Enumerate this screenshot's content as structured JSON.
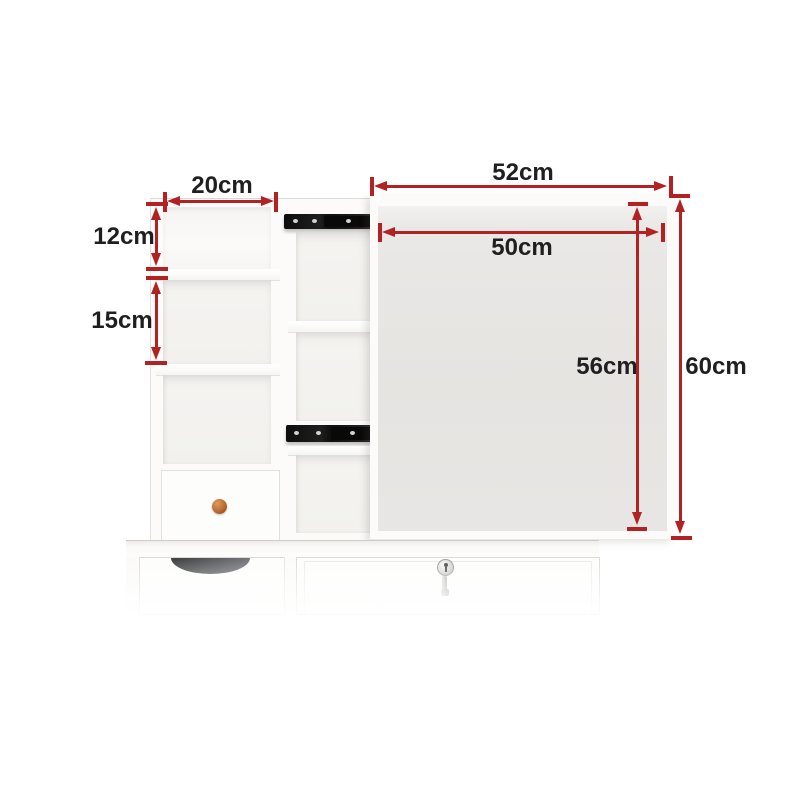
{
  "diagram": {
    "kind": "product-dimension-diagram",
    "subject": "white dresser hutch with shelves, small drawer and sliding mirror panel",
    "unit": "cm",
    "accent_color": "#b22222",
    "label_color": "#1f1f1f",
    "mirror_panel_color": "#e6e4e1",
    "hardware_color": "#161616",
    "knob_color": "#b96a33"
  },
  "dimensions": [
    {
      "id": "left-shelf-width",
      "label": "20cm"
    },
    {
      "id": "top-cubby-height",
      "label": "12cm"
    },
    {
      "id": "middle-cubby-height",
      "label": "15cm"
    },
    {
      "id": "mirror-outer-width",
      "label": "52cm"
    },
    {
      "id": "mirror-inner-width",
      "label": "50cm"
    },
    {
      "id": "mirror-inner-height",
      "label": "56cm"
    },
    {
      "id": "overall-height",
      "label": "60cm"
    }
  ]
}
